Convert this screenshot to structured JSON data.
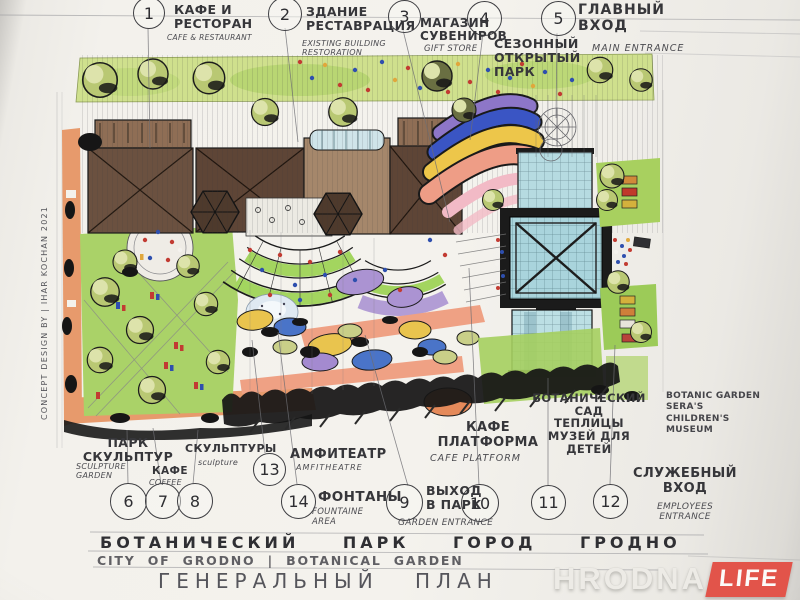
{
  "document": {
    "type": "hand-drawn landscape masterplan concept sketch",
    "credit": "CONCEPT DESIGN BY | IHAR KOCHAN 2021"
  },
  "callouts": [
    {
      "num": "1",
      "ru": "КАФЕ И\nРЕСТОРАН",
      "en": "CAFE & RESTAURANT"
    },
    {
      "num": "2",
      "ru": "ЗДАНИЕ\nРЕСТАВРАЦИЯ",
      "en": "EXISTING BUILDING\nRESTORATION"
    },
    {
      "num": "3",
      "ru": "МАГАЗИН\nСУВЕНИРОВ",
      "en": "GIFT STORE"
    },
    {
      "num": "4",
      "ru": "СЕЗОННЫЙ\nОТКРЫТЫЙ\nПАРК",
      "en": ""
    },
    {
      "num": "5",
      "ru": "ГЛАВНЫЙ\nВХОД",
      "en": "MAIN ENTRANCE"
    },
    {
      "num": "6",
      "ru": "ПАРК\nСКУЛЬПТУР",
      "en": "SCULPTURE\nGARDEN"
    },
    {
      "num": "7",
      "ru": "КАФЕ",
      "en": "COFFEE"
    },
    {
      "num": "8",
      "ru": "СКУЛЬПТУРЫ",
      "en": "sculpture"
    },
    {
      "num": "9",
      "ru": "ВЫХОД\nВ ПАРК",
      "en": "GARDEN ENTRANCE"
    },
    {
      "num": "10",
      "ru": "КАФЕ\nПЛАТФОРМА",
      "en": "CAFE PLATFORM"
    },
    {
      "num": "11",
      "ru": "БОТАНИЧЕСКИЙ\nСАД\nТЕПЛИЦЫ\nМУЗЕЙ ДЛЯ\nДЕТЕЙ",
      "en": ""
    },
    {
      "num": "12",
      "ru": "СЛУЖЕБНЫЙ\nВХОД",
      "en": "EMPLOYEES\nENTRANCE"
    },
    {
      "num": "13",
      "ru": "АМФИТЕАТР",
      "en": "AMFITHEATRE"
    },
    {
      "num": "14",
      "ru": "ФОНТАНЫ",
      "en": "FOUNTAINE\nAREA"
    }
  ],
  "side_note": "BOTANIC GARDEN\nSERA'S\nCHILDREN'S\nMUSEUM",
  "title_block": {
    "ru_title": "БОТАНИЧЕСКИЙ ПАРК ГОРОД ГРОДНО",
    "en_title": "CITY OF GRODNO | BOTANICAL GARDEN",
    "plan_label": "ГЕНЕРАЛЬНЫЙ ПЛАН"
  },
  "logo": {
    "name": "HRODNA",
    "suffix": "LIFE"
  },
  "colors": {
    "paper": "#f3f1ec",
    "ink": "#36363a",
    "pencil": "#6d6d72",
    "logo_red": "#e2544a",
    "lawn": "#aad268",
    "roof_brown": "#6b5140",
    "glass_blue": "#aed6dd",
    "path_orange": "#e79a6c",
    "band_purple": "#8d76c8",
    "band_blue": "#3a55c4",
    "band_yellow": "#edc64a",
    "band_salmon": "#ee9d86"
  }
}
